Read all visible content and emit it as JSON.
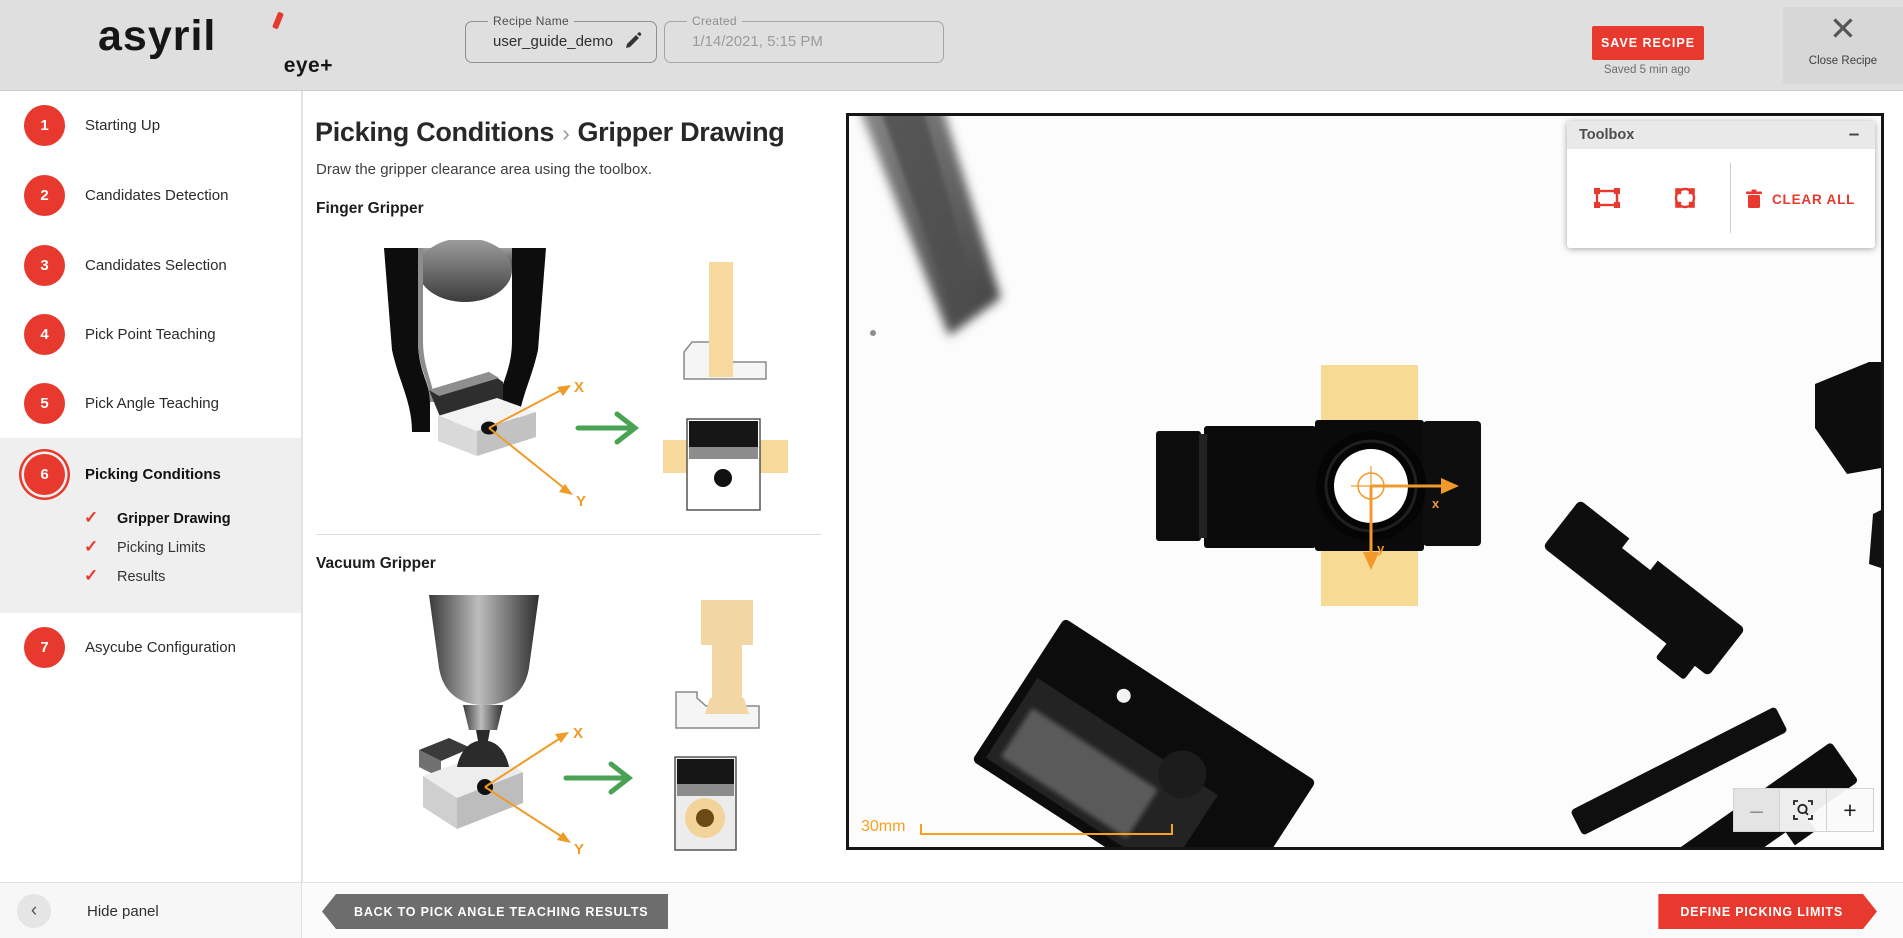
{
  "header": {
    "brand": {
      "name": "asyril",
      "sub": "eye+"
    },
    "recipe_name": {
      "label": "Recipe Name",
      "value": "user_guide_demo"
    },
    "created": {
      "label": "Created",
      "value": "1/14/2021, 5:15 PM"
    },
    "save_button": "SAVE RECIPE",
    "saved_status": "Saved 5 min ago",
    "close_recipe": "Close Recipe"
  },
  "sidebar": {
    "steps": [
      {
        "num": "1",
        "label": "Starting Up"
      },
      {
        "num": "2",
        "label": "Candidates Detection"
      },
      {
        "num": "3",
        "label": "Candidates Selection"
      },
      {
        "num": "4",
        "label": "Pick Point Teaching"
      },
      {
        "num": "5",
        "label": "Pick Angle Teaching"
      },
      {
        "num": "6",
        "label": "Picking Conditions"
      },
      {
        "num": "7",
        "label": "Asycube Configuration"
      }
    ],
    "substeps": [
      {
        "label": "Gripper Drawing"
      },
      {
        "label": "Picking Limits"
      },
      {
        "label": "Results"
      }
    ],
    "hide_panel": "Hide panel"
  },
  "main": {
    "breadcrumb": {
      "section": "Picking Conditions",
      "separator": "›",
      "page": "Gripper Drawing"
    },
    "instruction": "Draw the gripper clearance area using the toolbox.",
    "finger_gripper_label": "Finger Gripper",
    "vacuum_gripper_label": "Vacuum Gripper",
    "axis_x": "X",
    "axis_y": "Y"
  },
  "toolbox": {
    "title": "Toolbox",
    "minimize": "–",
    "clear_all": "CLEAR ALL"
  },
  "viewer": {
    "scale_label": "30mm",
    "zoom_out": "–",
    "zoom_in": "+",
    "axis_x": "x",
    "axis_y": "y"
  },
  "footer": {
    "back_button": "BACK TO PICK ANGLE TEACHING RESULTS",
    "next_button": "DEFINE PICKING LIMITS"
  },
  "icons": {
    "check": "✓",
    "chevron_left": "‹",
    "close": "✕"
  },
  "colors": {
    "accent": "#e8392e",
    "orange": "#f2992b",
    "tan": "#f7da93",
    "green": "#4aa355"
  }
}
